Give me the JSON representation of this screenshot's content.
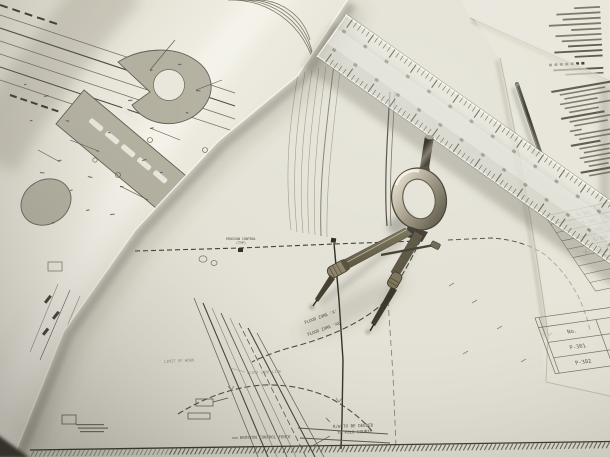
{
  "plan_labels": {
    "erosion_control_line1": "EROSION CONTROL",
    "erosion_control_line2": "(TYP)",
    "flood_zone_x": "FLOOD ZONE 'X'",
    "flood_zone_ae": "FLOOD ZONE 'AE'",
    "limit_of_work": "LIMIT OF WORK",
    "flood_zone_line": "FLOOD ZONE LINE",
    "erosion_control_fence": "EROSION CONTROL FENCE",
    "rw_deeded_line1": "R/W TO BE DEEDED",
    "rw_deeded_line2": "TO POLK COUNTY"
  },
  "tables": {
    "structural": {
      "rows": [
        "S-301",
        "S-302",
        "S-303",
        "S-304",
        "S-305",
        "S-306",
        "S-307",
        "S-308",
        "S-400"
      ]
    },
    "proposed": {
      "header_no": "No.",
      "header_desc_line1": "PROPOSED",
      "header_desc_line2": "STRUCTURE",
      "rows": [
        "P-301",
        "P-302"
      ]
    }
  },
  "colors": {
    "paper": "#e4e2d6",
    "paper_bright": "#f1efe5",
    "ink_dark": "#2b2924",
    "ink_mid": "#5a584c",
    "plan_shading": "#b3b0a0",
    "metal_dark": "#3c382e",
    "metal_light": "#b9b29e",
    "shadow": "#5a5846"
  }
}
